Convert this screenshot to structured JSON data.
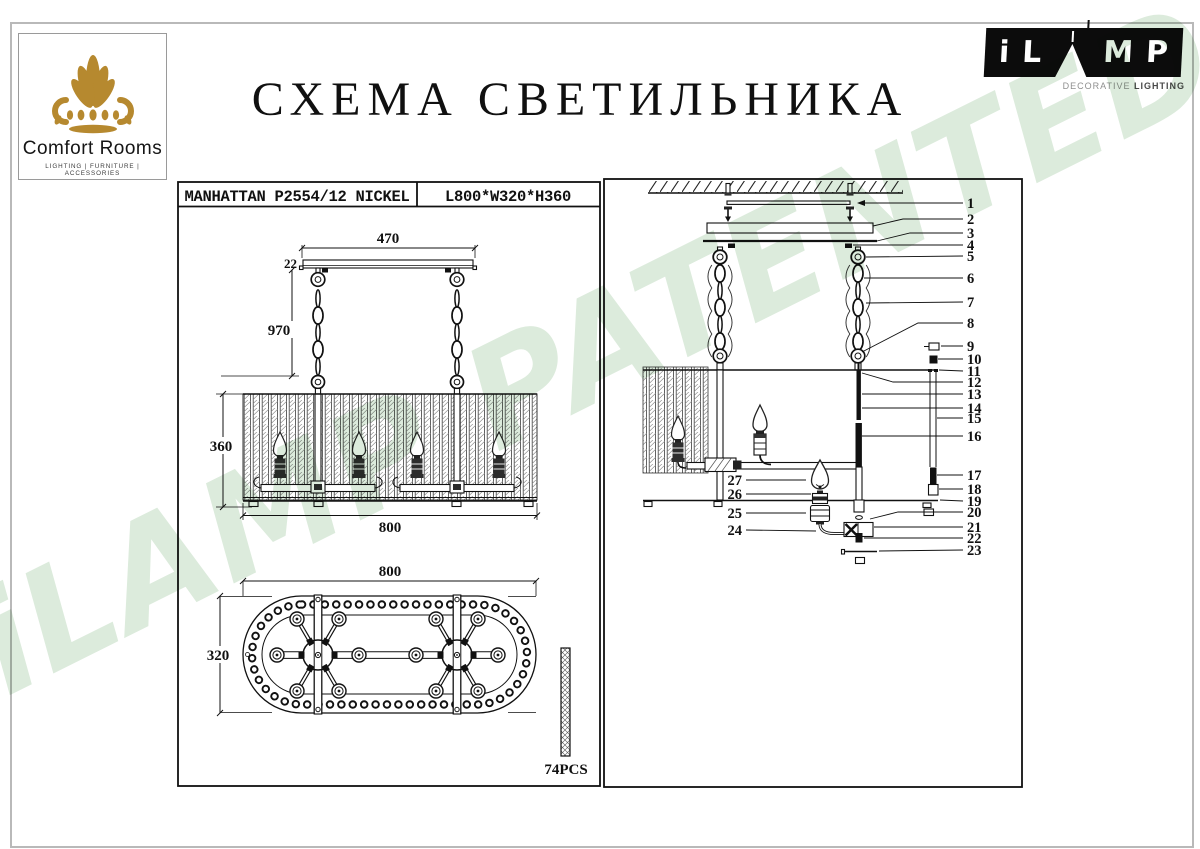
{
  "header": {
    "title": "СХЕМА СВЕТИЛЬНИКА"
  },
  "comfort_logo": {
    "name": "Comfort Rooms",
    "tagline": "LIGHTING | FURNITURE | ACCESSORIES",
    "gold": "#b6892f"
  },
  "ilamp_logo": {
    "letters": {
      "i": "i",
      "l": "L",
      "m": "M",
      "p": "P"
    },
    "tagline_light": "DECORATIVE",
    "tagline_bold": "LIGHTING"
  },
  "spec_table": {
    "model": "MANHATTAN P2554/12 NICKEL",
    "dimensions": "L800*W320*H360"
  },
  "front_view": {
    "canopy_width": "470",
    "canopy_thickness": "22",
    "suspension_length": "970",
    "shade_height": "360",
    "shade_length": "800"
  },
  "bottom_view": {
    "length": "800",
    "width": "320",
    "crystal_count": "74PCS"
  },
  "exploded_view": {
    "callouts_right": [
      "1",
      "2",
      "3",
      "4",
      "5",
      "6",
      "7",
      "8",
      "9",
      "10",
      "11",
      "12",
      "13",
      "14",
      "15",
      "16",
      "17",
      "18",
      "19",
      "20",
      "21",
      "22",
      "23"
    ],
    "callouts_left": [
      "27",
      "26",
      "25",
      "24"
    ]
  },
  "watermark": {
    "text": "iLAMP PATENTED",
    "color": "#dcebdc"
  }
}
